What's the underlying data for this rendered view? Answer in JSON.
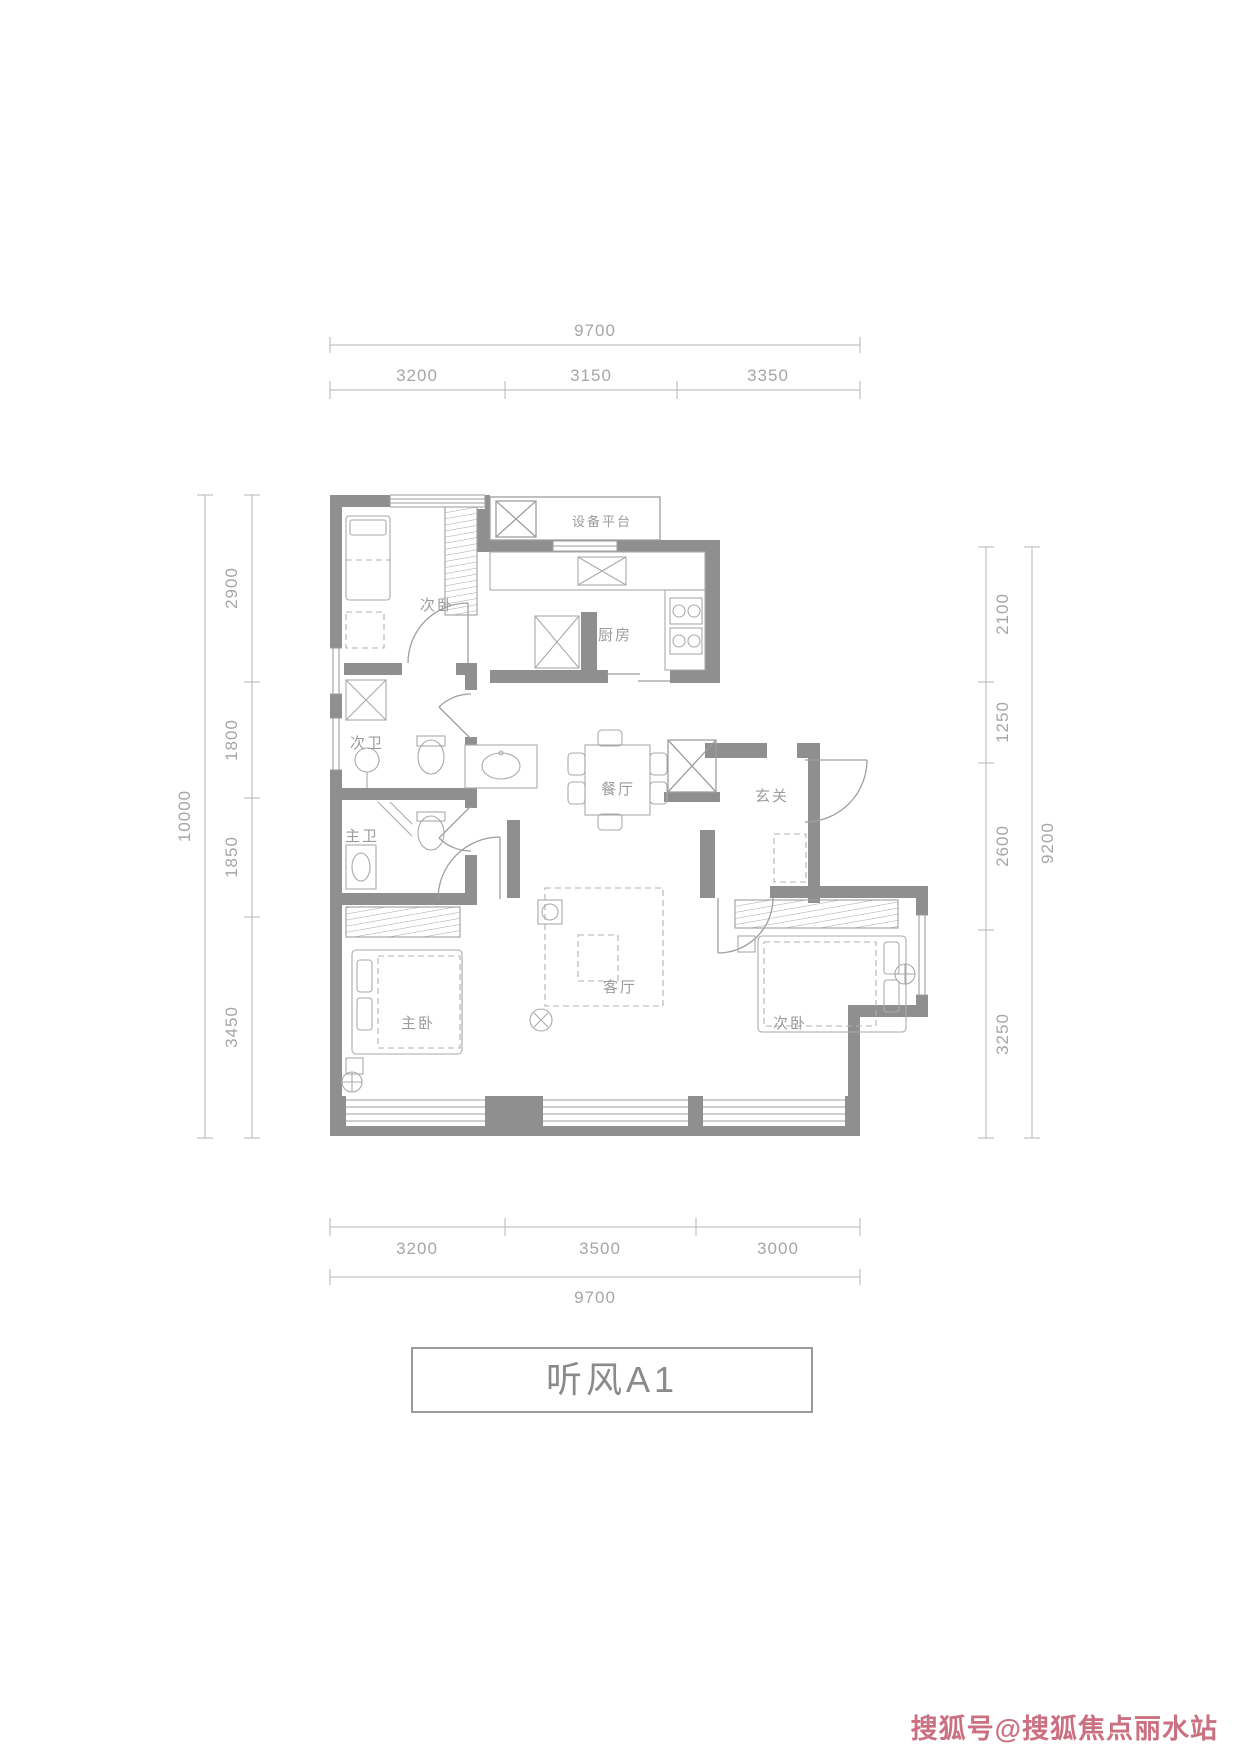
{
  "plan": {
    "title": "听风A1",
    "watermark": "搜狐号@搜狐焦点丽水站",
    "rooms": {
      "tl_bedroom": "次卧",
      "equipment_platform": "设备平台",
      "kitchen": "厨房",
      "secondary_bath": "次卫",
      "master_bath": "主卫",
      "dining": "餐厅",
      "foyer": "玄关",
      "master_bedroom": "主卧",
      "living": "客厅",
      "br_bedroom": "次卧"
    },
    "dimensions": {
      "top": {
        "total": "9700",
        "segments": [
          "3200",
          "3150",
          "3350"
        ]
      },
      "bottom": {
        "total": "9700",
        "segments": [
          "3200",
          "3500",
          "3000"
        ]
      },
      "left": {
        "total": "10000",
        "segments": [
          "2900",
          "1800",
          "1850",
          "3450"
        ]
      },
      "right": {
        "total": "9200",
        "segments": [
          "2100",
          "1250",
          "2600",
          "3250"
        ]
      }
    },
    "colors": {
      "wall": "#8f8f8f",
      "line": "#9e9e9e",
      "dim_text": "#a6a6a6",
      "label_text": "#9c9c9c",
      "watermark": "#c9697a"
    }
  }
}
